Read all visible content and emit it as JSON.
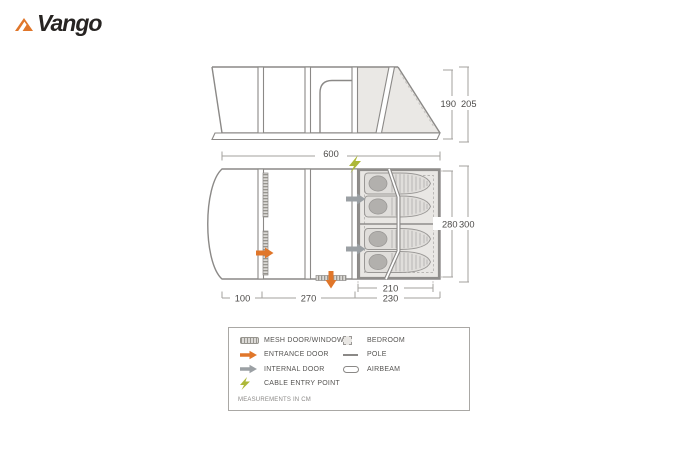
{
  "logo": {
    "text": "Vango"
  },
  "side_view": {
    "dim_height_inner": "190",
    "dim_height_outer": "205",
    "dim_length": "600"
  },
  "floor_plan": {
    "dim_depth_inner": "280",
    "dim_depth_outer": "300",
    "dim_front_porch": "100",
    "dim_living_area": "270",
    "dim_bedroom_inner": "210",
    "dim_bedroom_outer": "230"
  },
  "legend": {
    "items_left": [
      {
        "icon": "mesh-door-window-icon",
        "label": "MESH DOOR/WINDOW"
      },
      {
        "icon": "entrance-door-icon",
        "label": "ENTRANCE DOOR"
      },
      {
        "icon": "internal-door-icon",
        "label": "INTERNAL DOOR"
      },
      {
        "icon": "cable-entry-point-icon",
        "label": "CABLE ENTRY POINT"
      }
    ],
    "items_right": [
      {
        "icon": "bedroom-icon",
        "label": "BEDROOM"
      },
      {
        "icon": "pole-icon",
        "label": "POLE"
      },
      {
        "icon": "airbeam-icon",
        "label": "AIRBEAM"
      }
    ],
    "note": "MEASUREMENTS IN CM"
  },
  "colors": {
    "brand_orange": "#e0762a",
    "internal_door_gray": "#9ba0a4",
    "cable_green": "#adb838",
    "bedroom_fill": "#e9e7e4",
    "line_gray": "#8b8987"
  }
}
